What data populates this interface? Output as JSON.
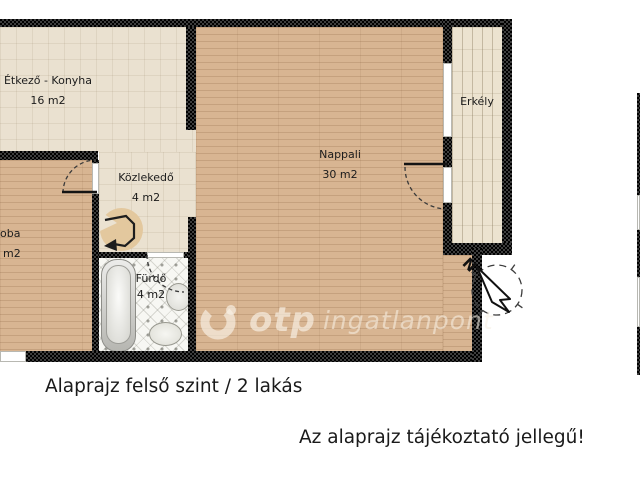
{
  "rooms": {
    "kitchen": {
      "label": "Étkező - Konyha",
      "area": "16 m2"
    },
    "hallway": {
      "label": "Közlekedő",
      "area": "4 m2"
    },
    "living": {
      "label": "Nappali",
      "area": "30 m2"
    },
    "balcony": {
      "label": "Erkély"
    },
    "bedroom": {
      "label": "oba",
      "area": "m2"
    },
    "bathroom": {
      "label": "Fürdő",
      "area": "4 m2"
    }
  },
  "captions": {
    "title": "Alaprajz felső szint / 2 lakás",
    "disclaimer": "Az alaprajz tájékoztató jellegű!"
  },
  "watermark": {
    "brand": "otp",
    "suffix": "ingatlanpont"
  },
  "compass": {
    "north": "N"
  },
  "colors": {
    "wood_floor": "#d8b592",
    "kitchen_tile": "#eae1d0",
    "balcony_deck": "#ece3d0",
    "bath_tile": "#f7f7f3",
    "wall": "#141414",
    "stair_circle": "#e3c89e",
    "watermark_text": "#f2e9d8"
  }
}
